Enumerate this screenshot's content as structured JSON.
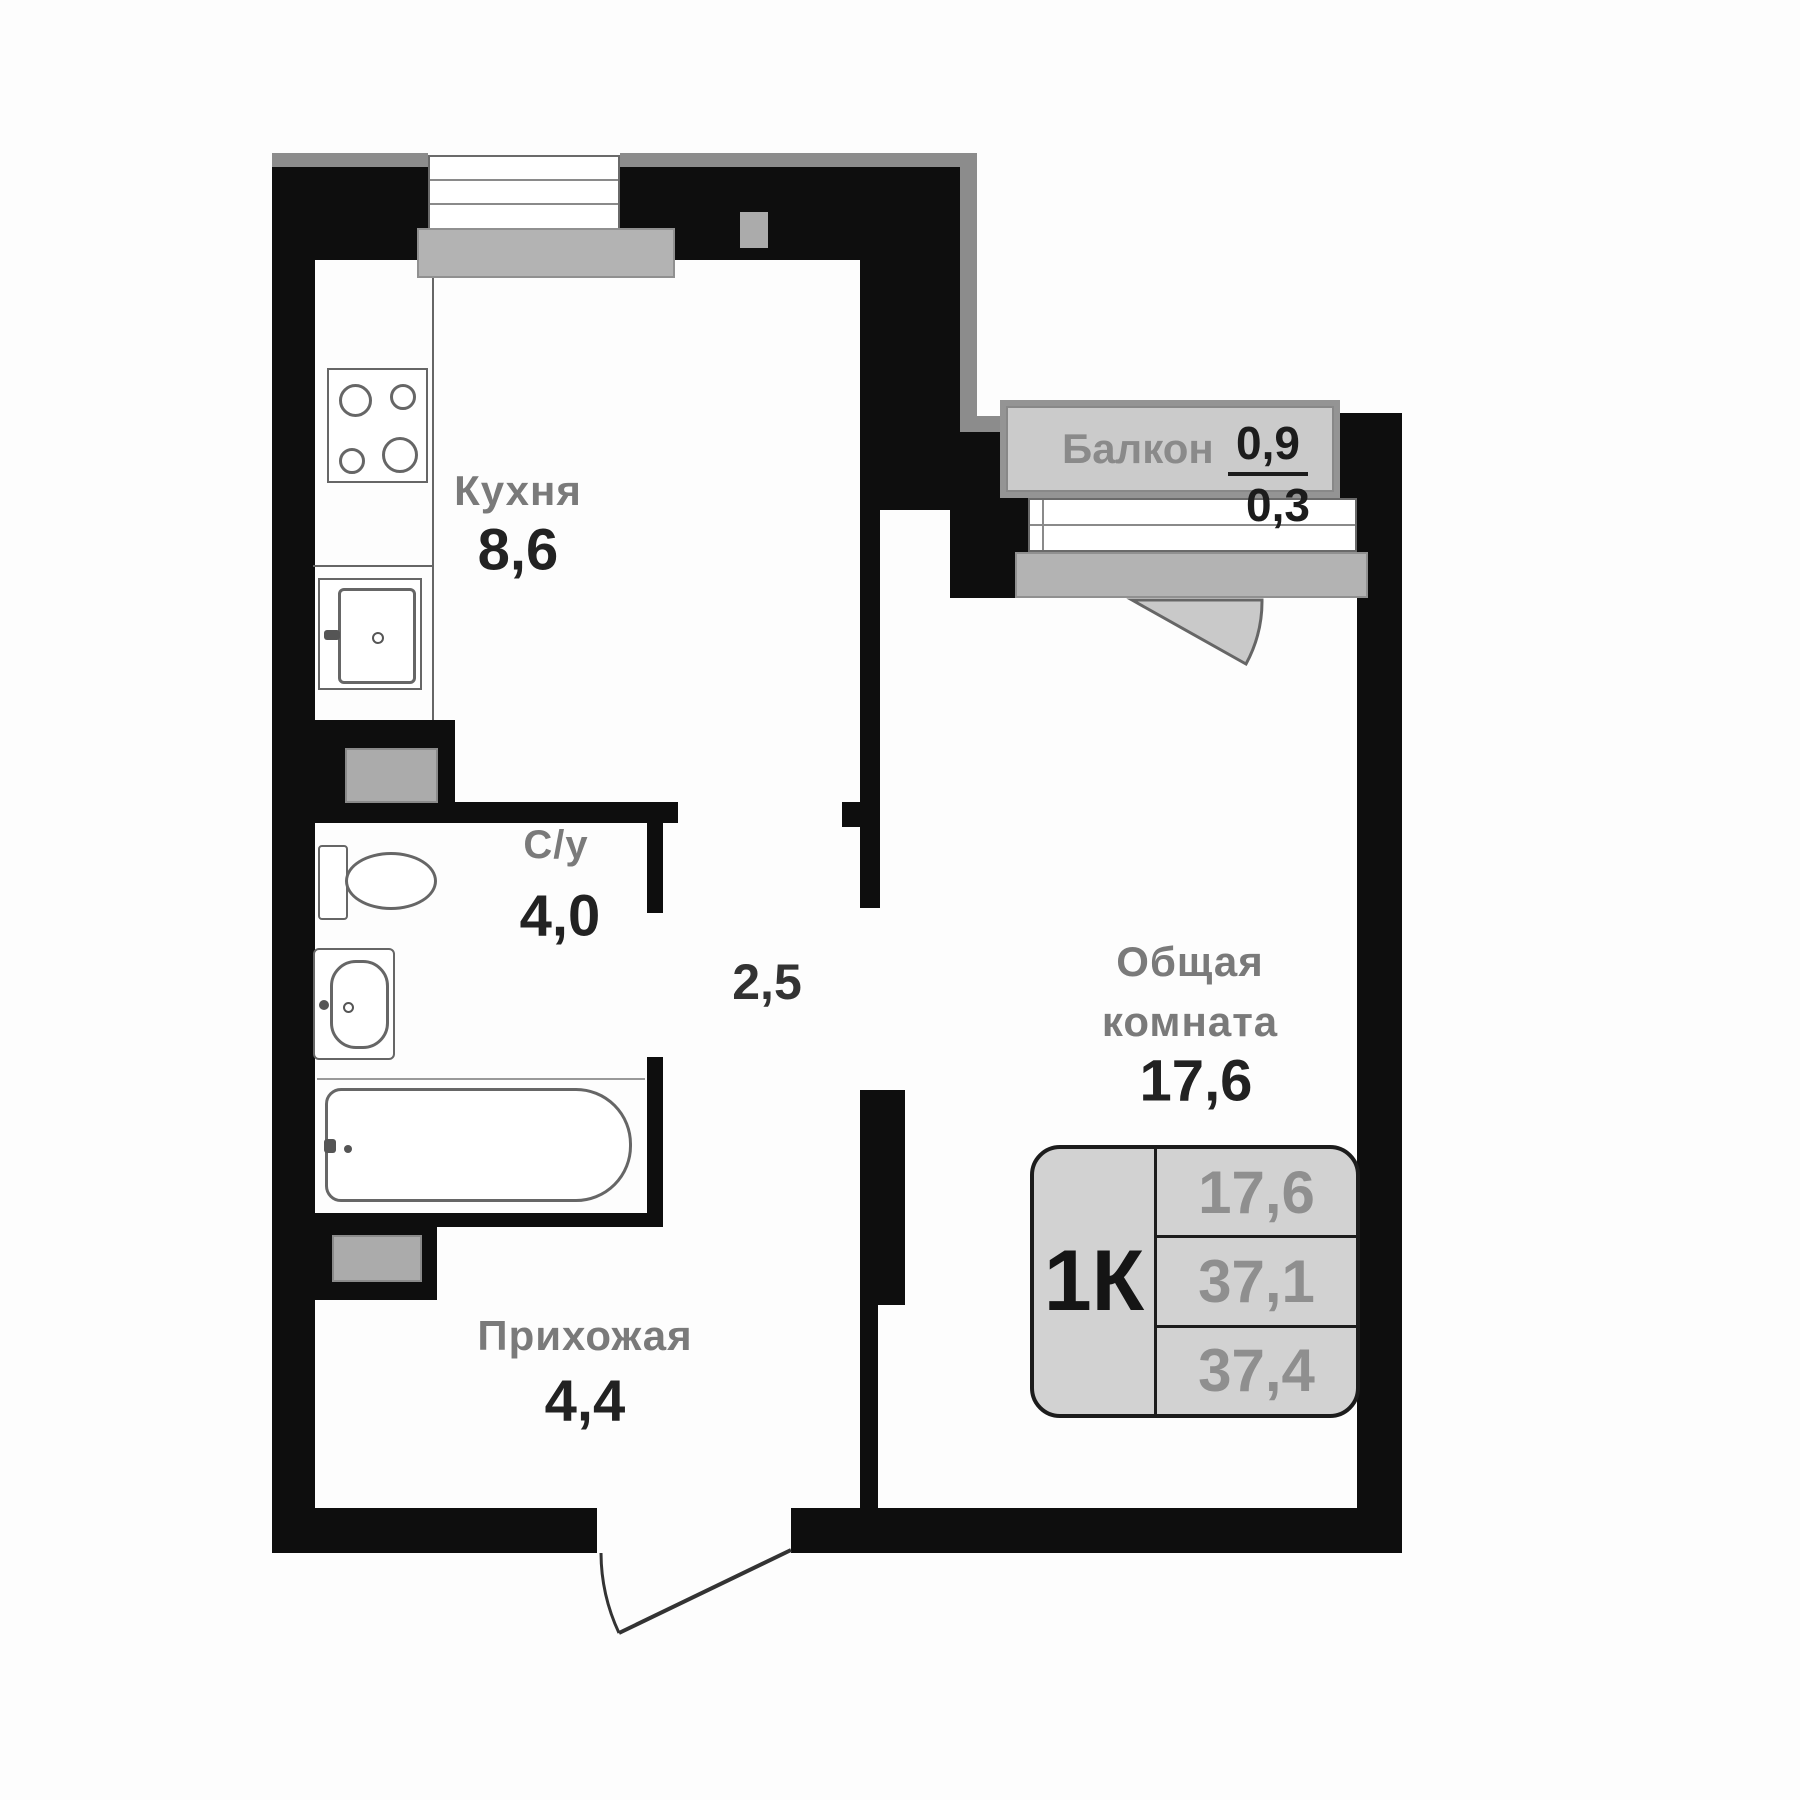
{
  "plan_type": "apartment-floor-plan",
  "rooms": {
    "kitchen": {
      "name": "Кухня",
      "area": "8,6"
    },
    "bathroom": {
      "name": "С/у",
      "area": "4,0"
    },
    "corridor": {
      "area": "2,5"
    },
    "hallway": {
      "name": "Прихожая",
      "area": "4,4"
    },
    "living": {
      "name_line1": "Общая",
      "name_line2": "комната",
      "area": "17,6"
    },
    "balcony": {
      "name": "Балкон",
      "area_full": "0,9",
      "area_reduced": "0,3"
    }
  },
  "badge": {
    "room_type": "1К",
    "living_area": "17,6",
    "apartment_area": "37,1",
    "total_area": "37,4"
  },
  "fixtures": [
    "stove-icon",
    "kitchen-sink-icon",
    "toilet-icon",
    "sink-icon",
    "bathtub-icon",
    "entrance-door-icon",
    "balcony-door-icon",
    "window-icon",
    "vent-shaft-icon"
  ],
  "colors": {
    "wall": "#0e0e0e",
    "trim": "#8c8c8c",
    "shaft": "#ababab",
    "sill": "#b3b3b3",
    "balcony_fill": "#cbcbcb",
    "badge_fill": "#d2d2d2",
    "room_name_gray": "#7a7a7a",
    "number_dark": "#222222",
    "badge_value_gray": "#8f8f8f"
  }
}
